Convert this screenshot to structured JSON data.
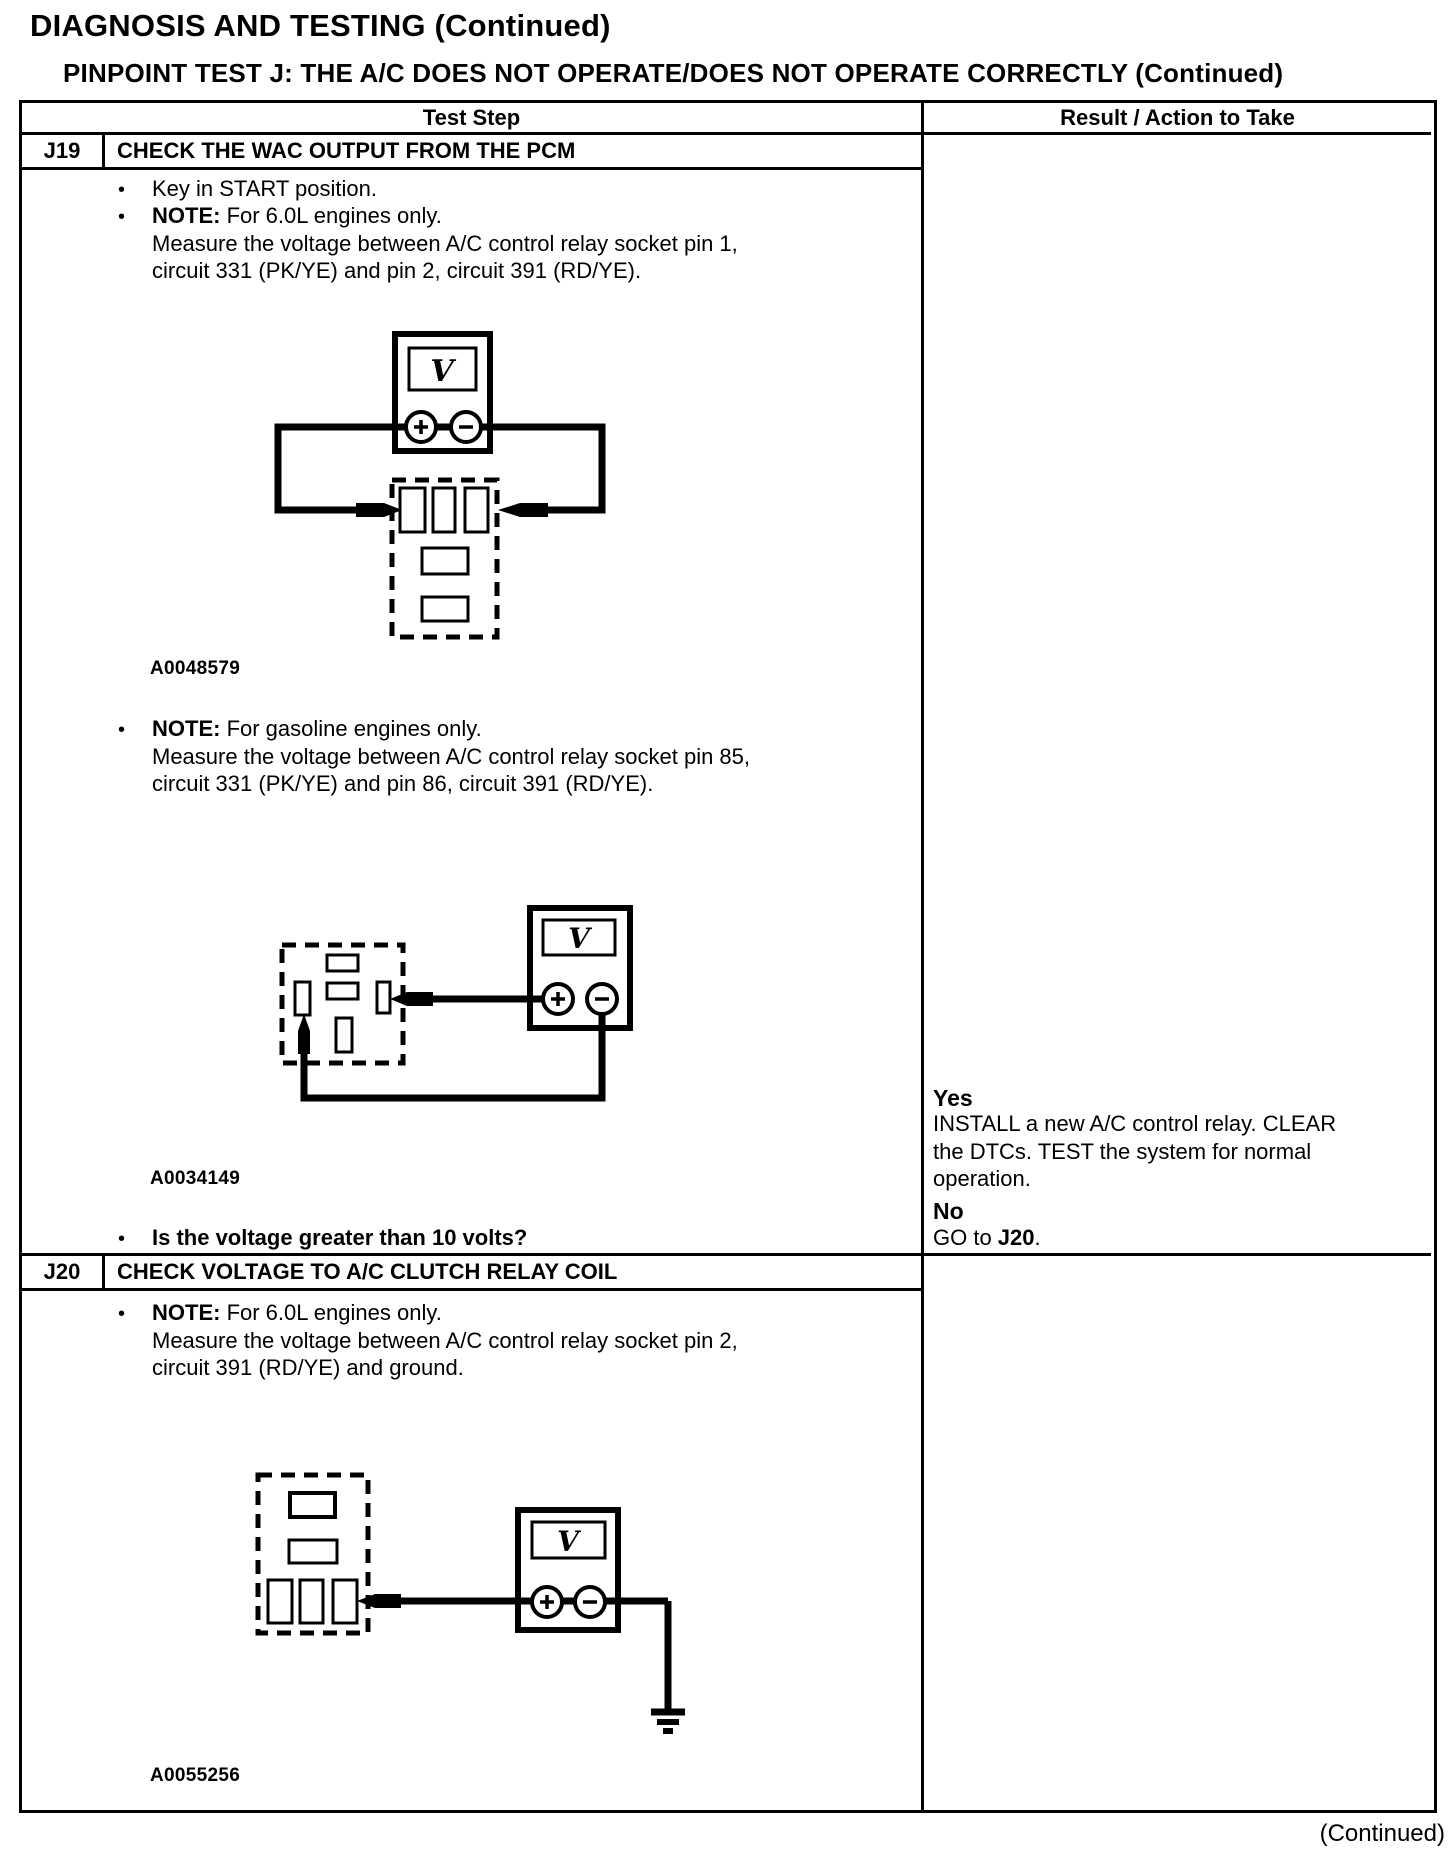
{
  "header": {
    "title": "DIAGNOSIS AND TESTING (Continued)",
    "subtitle": "PINPOINT TEST J: THE A/C DOES NOT OPERATE/DOES NOT OPERATE CORRECTLY (Continued)"
  },
  "table": {
    "columns": {
      "test_step": "Test Step",
      "result": "Result / Action to Take"
    },
    "j19": {
      "id": "J19",
      "title": "CHECK THE WAC OUTPUT FROM THE PCM",
      "step1": "Key in START position.",
      "note1": {
        "label": "NOTE:",
        "text": " For 6.0L engines only."
      },
      "measure1": {
        "line1": "Measure the voltage between A/C control relay socket pin 1,",
        "line2": "circuit 331 (PK/YE) and pin 2, circuit 391 (RD/YE)."
      },
      "figure1": "A0048579",
      "note2": {
        "label": "NOTE:",
        "text": " For gasoline engines only."
      },
      "measure2": {
        "line1": "Measure the voltage between A/C control relay socket pin 85,",
        "line2": "circuit 331 (PK/YE) and pin 86, circuit 391 (RD/YE)."
      },
      "figure2": "A0034149",
      "question": "Is the voltage greater than 10 volts?",
      "result": {
        "yes_label": "Yes",
        "yes_line1": "INSTALL a new A/C control relay. CLEAR",
        "yes_line2": "the DTCs. TEST the system for normal",
        "yes_line3": "operation.",
        "no_label": "No",
        "goto_prefix": "GO to ",
        "goto_target": "J20",
        "goto_suffix": "."
      }
    },
    "j20": {
      "id": "J20",
      "title": "CHECK VOLTAGE TO A/C CLUTCH RELAY COIL",
      "note1": {
        "label": "NOTE:",
        "text": " For 6.0L engines only."
      },
      "measure1": {
        "line1": "Measure the voltage between A/C control relay socket pin 2,",
        "line2": "circuit 391 (RD/YE) and ground."
      },
      "figure1": "A0055256"
    }
  },
  "glyphs": {
    "bullet": "•",
    "voltmeter": "V"
  },
  "footer": {
    "continued": "(Continued)"
  }
}
